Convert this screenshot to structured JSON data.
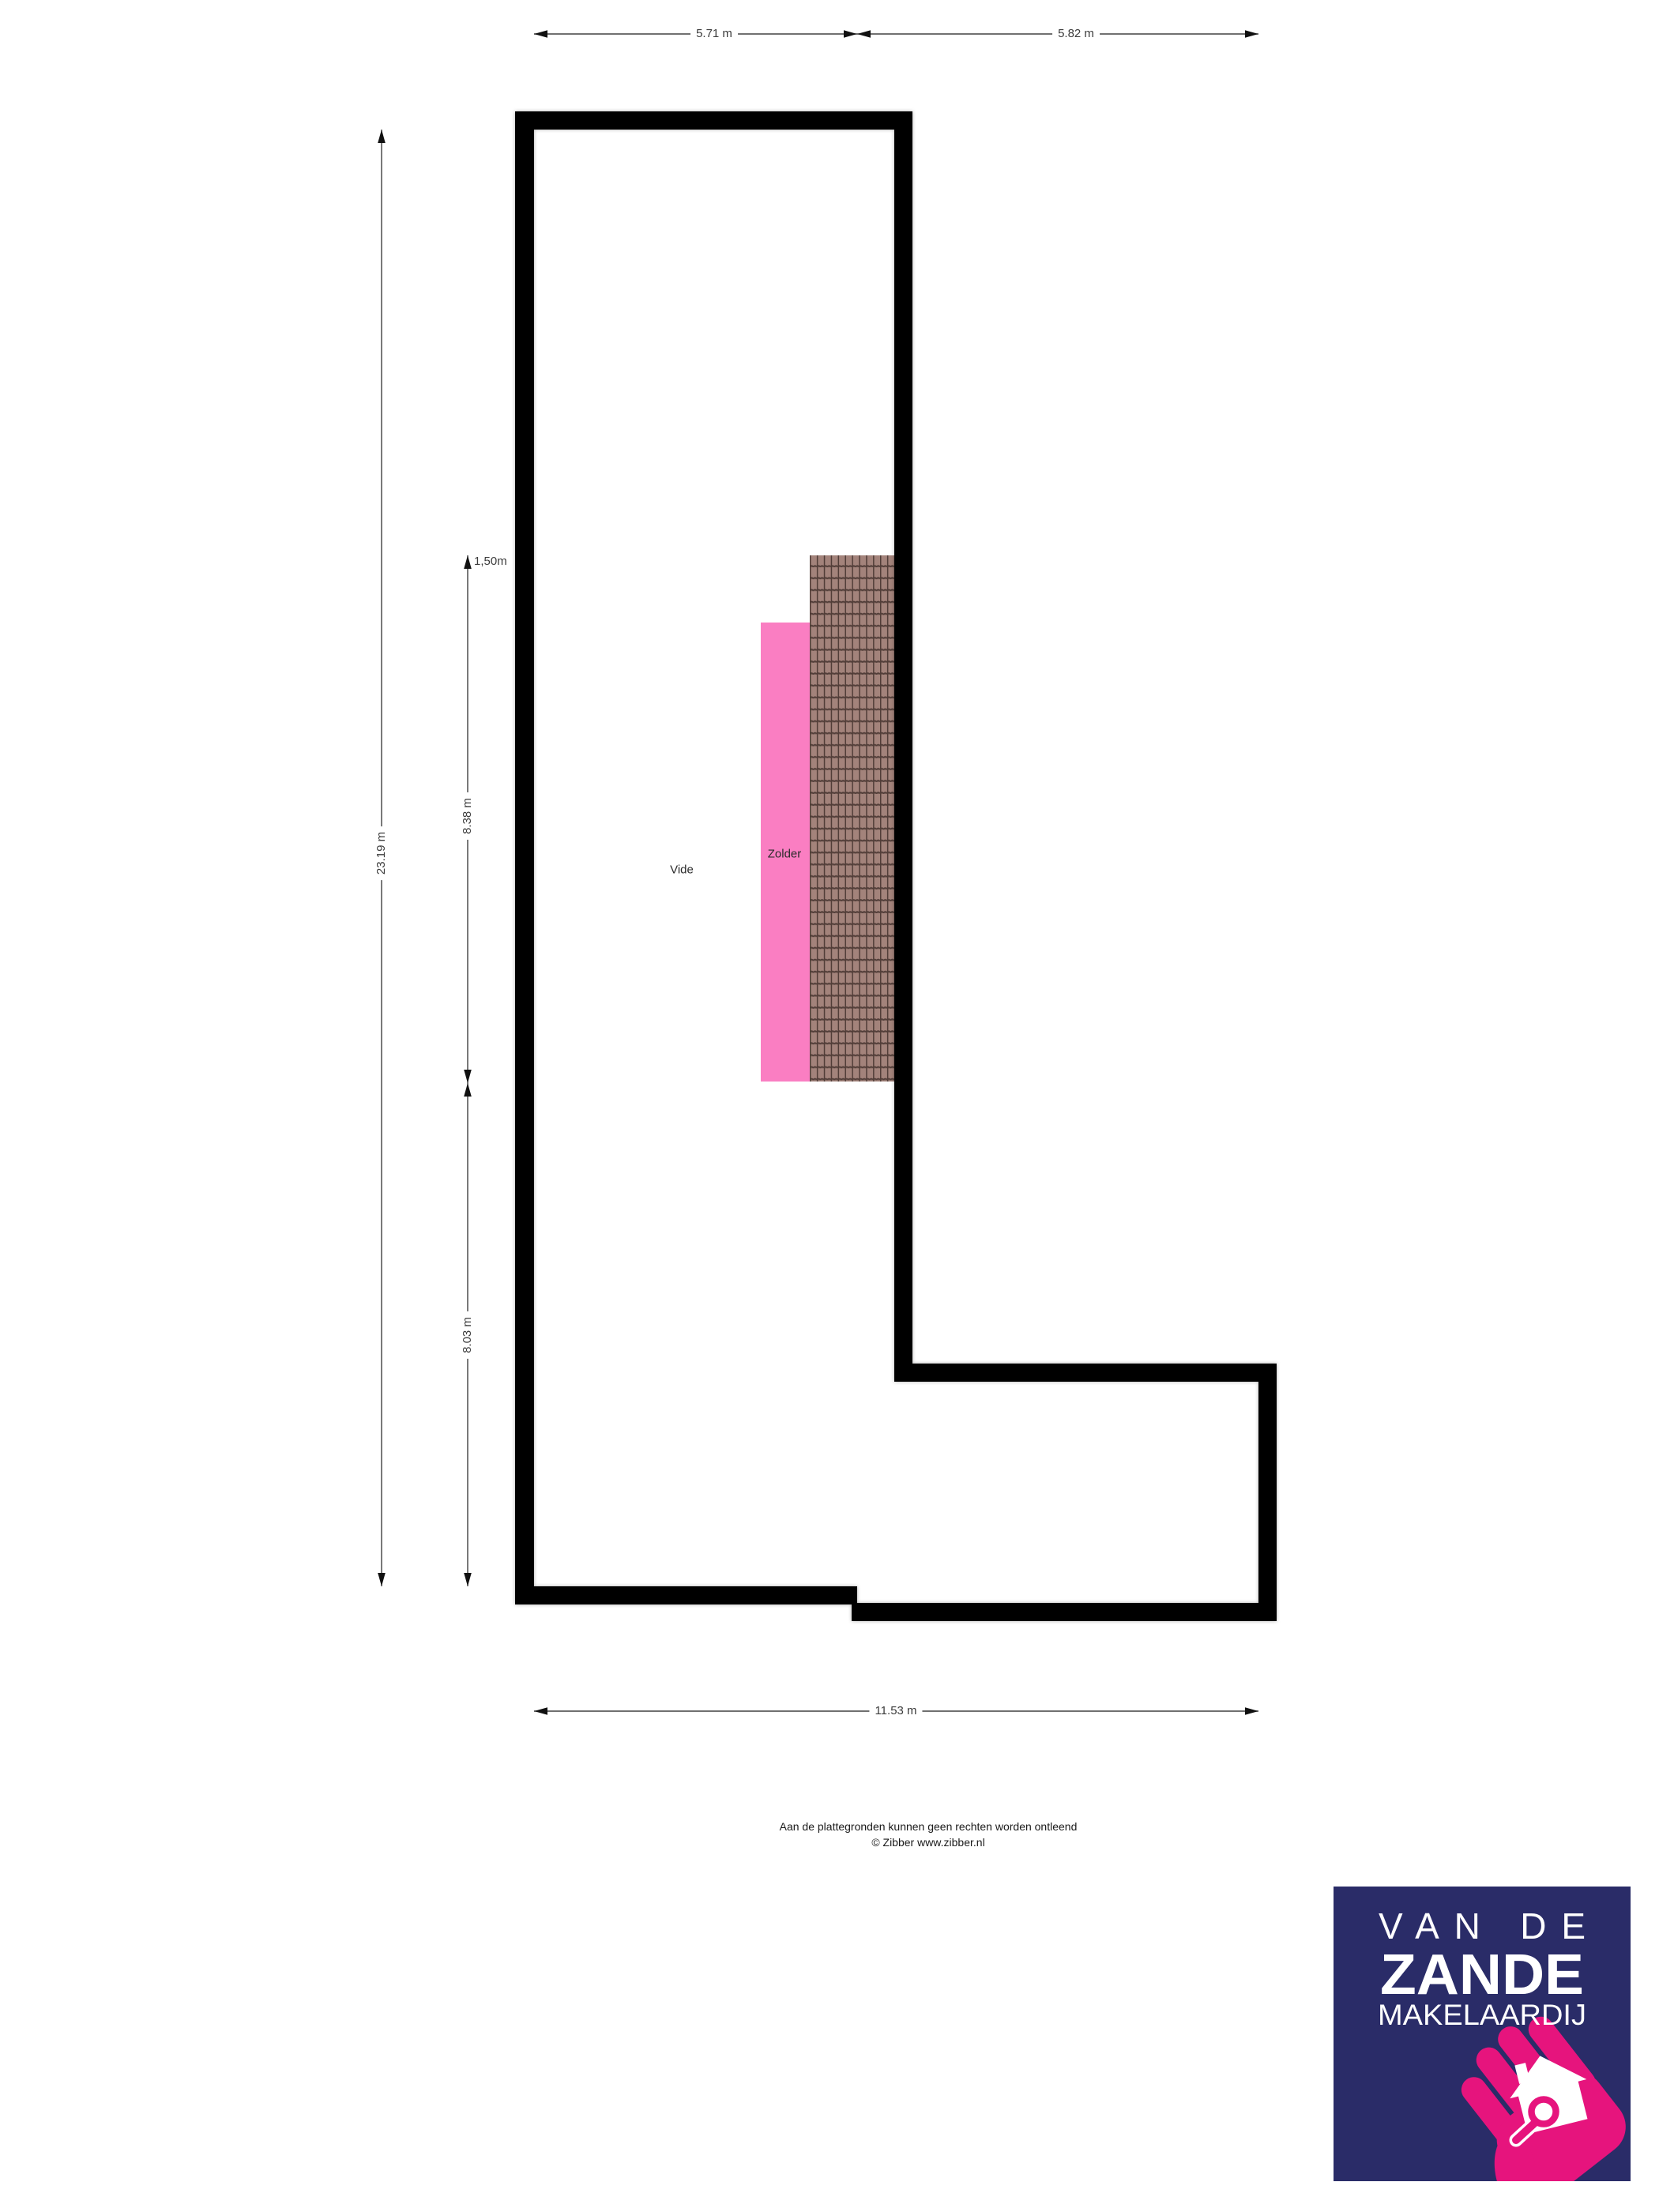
{
  "page": {
    "background": "#ffffff",
    "type": "floorplan-attic-level"
  },
  "floorplan": {
    "rooms": [
      {
        "label": "Vide"
      },
      {
        "label": "Zolder"
      }
    ],
    "dimensions": {
      "top_left_width": "5.71 m",
      "top_right_width": "5.82 m",
      "left_total_height": "23.19 m",
      "headroom_line": "1,50m",
      "upper_segment_height": "8.38 m",
      "lower_segment_height": "8.03 m",
      "bottom_total_width": "11.53 m"
    },
    "colors": {
      "wall": "#000000",
      "zolder_fill": "#FA7EC2",
      "roof_tile_base": "#A3837B",
      "roof_tile_line": "#513D38",
      "dimension_line": "#404040",
      "dimension_text": "#3c3c3c"
    }
  },
  "footer": {
    "disclaimer_line1": "Aan de plattegronden kunnen geen rechten worden ontleend",
    "disclaimer_line2": "© Zibber www.zibber.nl"
  },
  "logo": {
    "line1": "VAN DE",
    "line2": "ZANDE",
    "line3": "MAKELAARDIJ",
    "icon": "house-with-magnifier-in-hand",
    "colors": {
      "background": "#2A2C68",
      "accent": "#E6147D",
      "text": "#FFFFFF"
    }
  }
}
